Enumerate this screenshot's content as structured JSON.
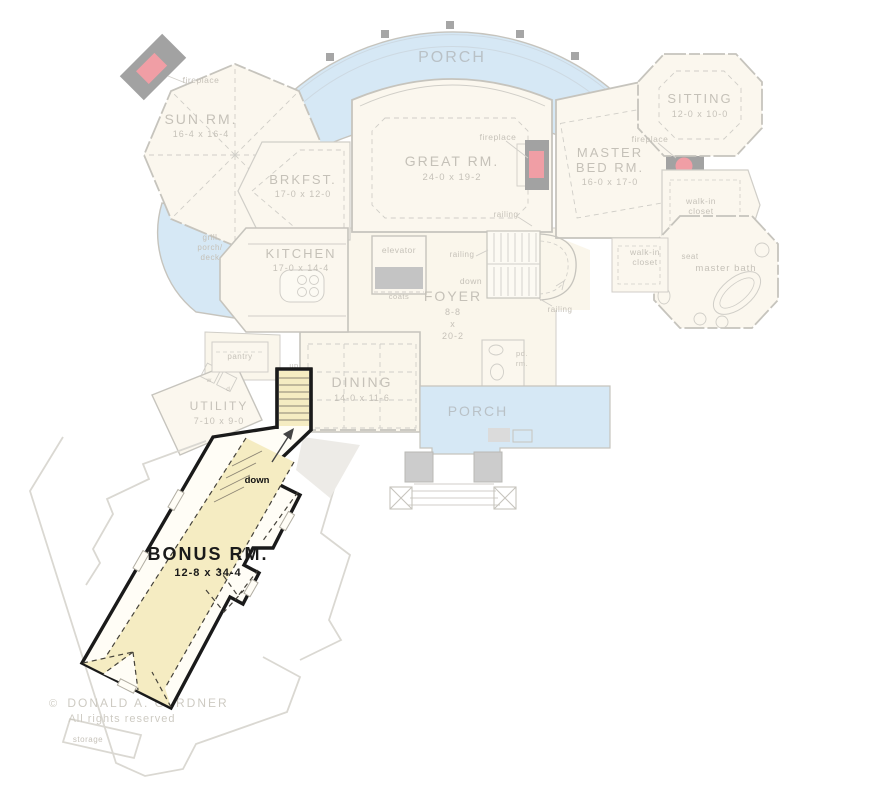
{
  "plan_title": "First floor plan with bonus room highlighted",
  "colors": {
    "highlight_yellow": "#f5ecc2",
    "porch_blue": "#aed2ec",
    "outline_black": "#1a1a1a",
    "fireplace_red": "#e2404e",
    "chimney_gray": "#474747",
    "faded_ink": "#8d8474",
    "porch_text": "#8795a3"
  },
  "rooms": {
    "porch_top": {
      "label": "PORCH"
    },
    "porch_bottom": {
      "label": "PORCH"
    },
    "sun_room": {
      "label": "SUN RM.",
      "dims": "16-4 x 16-4"
    },
    "brkfst": {
      "label": "BRKFST.",
      "dims": "17-0 x 12-0"
    },
    "great_room": {
      "label": "GREAT RM.",
      "dims": "24-0 x 19-2"
    },
    "master_bed": {
      "line1": "MASTER",
      "line2": "BED RM.",
      "dims": "16-0 x 17-0"
    },
    "sitting": {
      "label": "SITTING",
      "dims": "12-0 x 10-0"
    },
    "kitchen": {
      "label": "KITCHEN",
      "dims": "17-0 x 14-4"
    },
    "foyer": {
      "label": "FOYER",
      "dims_w": "8-8",
      "dims_x": "x",
      "dims_l": "20-2"
    },
    "dining": {
      "label": "DINING",
      "dims": "14-0 x 11-6"
    },
    "utility": {
      "label": "UTILITY",
      "dims": "7-10 x 9-0"
    },
    "bonus": {
      "label": "BONUS RM.",
      "dims": "12-8 x 34-4"
    },
    "grill_porch": {
      "line1": "grill",
      "line2": "porch/",
      "line3": "deck"
    },
    "master_bath": {
      "label": "master bath"
    },
    "walkin_upper": {
      "line1": "walk-in",
      "line2": "closet"
    },
    "walkin_lower": {
      "line1": "walk-in",
      "line2": "closet"
    },
    "powder": {
      "line1": "pd.",
      "line2": "rm."
    },
    "pantry": {
      "label": "pantry"
    },
    "storage": {
      "label": "storage"
    },
    "seat": {
      "label": "seat"
    },
    "elevator": {
      "label": "elevator"
    },
    "coats": {
      "label": "coats"
    }
  },
  "annotations": {
    "fireplace": "fireplace",
    "railing": "railing"
  },
  "stairs": {
    "up": "up",
    "down": "down"
  },
  "laundry": {
    "washer": "w",
    "dryer": "d"
  },
  "copyright": {
    "symbol": "©",
    "owner": "DONALD A. GARDNER",
    "rights": "All rights reserved"
  }
}
